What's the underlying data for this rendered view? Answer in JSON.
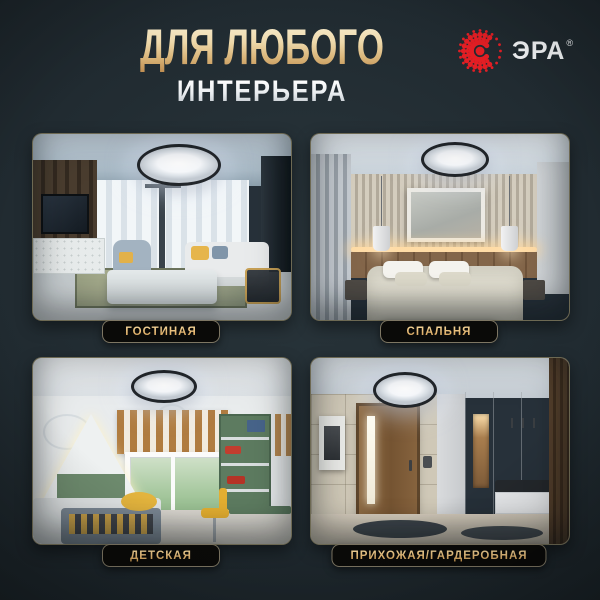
{
  "header": {
    "title_line1": "ДЛЯ ЛЮБОГО",
    "title_line2": "ИНТЕРЬЕРА"
  },
  "brand": {
    "name": "ЭРА",
    "registered": "®"
  },
  "rooms": [
    {
      "label": "ГОСТИНАЯ"
    },
    {
      "label": "СПАЛЬНЯ"
    },
    {
      "label": "ДЕТСКАЯ"
    },
    {
      "label": "ПРИХОЖАЯ/ГАРДЕРОБНАЯ"
    }
  ],
  "colors": {
    "background": "#1f292e",
    "title_gold_light": "#f7ecd0",
    "title_gold_dark": "#c08e52",
    "subtitle_silver": "#e8ecef",
    "badge_background": "#0a0a08",
    "badge_border": "#7d7663",
    "badge_text_gold": "#e3b671",
    "logo_red": "#e31e24"
  }
}
